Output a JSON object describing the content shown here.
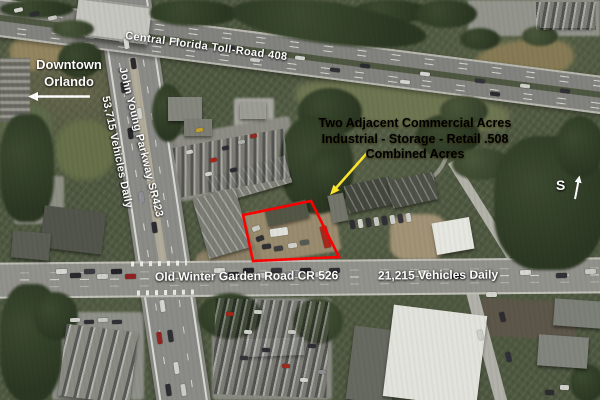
{
  "annotations": {
    "toll_road_label": "Central Florida Toll-Road 408",
    "downtown_label": "Downtown Orlando",
    "parkway_label": "John Young Parkway SR423",
    "parkway_traffic_label": "53,715 Vehicles Daily",
    "property_note_line1": "Two Adjacent Commercial Acres",
    "property_note_line2": "Industrial - Storage - Retail .508",
    "property_note_line3": "Combined Acres",
    "road_label": "Old Winter Garden Road CR 526",
    "road_traffic_label": "21,215 Vehicles Daily",
    "compass_label": "S"
  },
  "colors": {
    "annotation_yellow": "#FFE72E",
    "property_outline_red": "#FF0000",
    "label_white": "#FFFFFF"
  }
}
